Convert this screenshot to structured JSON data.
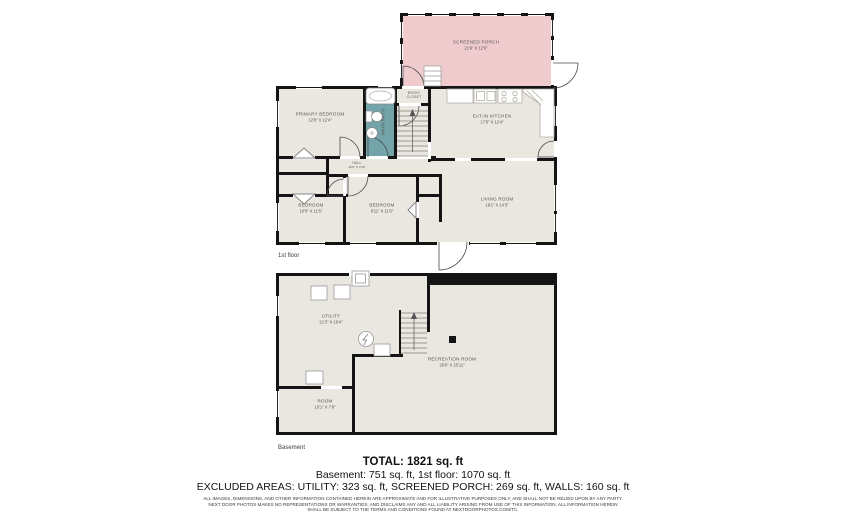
{
  "colors": {
    "floor_fill": "#e9e7e0",
    "wall": "#141414",
    "porch_fill": "#efcbce",
    "bath_fill": "#72a4aa",
    "label_text": "#56564e"
  },
  "first_floor": {
    "caption": "1st floor",
    "porch": {
      "name": "SCREENED PORCH",
      "dims": "21'9\" X 12'6\""
    },
    "primary_bedroom": {
      "name": "PRIMARY BEDROOM",
      "dims": "12'8\" X 12'4\""
    },
    "bath": {
      "name": "MAIN BATH"
    },
    "entry_closet": {
      "line1": "ENTRY",
      "line2": "CLOSET"
    },
    "kitchen": {
      "name": "EAT-IN KITCHEN",
      "dims": "17'8\" X 12'4\""
    },
    "hall": {
      "name": "HALL",
      "dims": "16'3\" X 3'10\""
    },
    "bedroom_left": {
      "name": "BEDROOM",
      "dims": "10'8\" X 11'6\""
    },
    "bedroom_mid": {
      "name": "BEDROOM",
      "dims": "8'11\" X 11'6\""
    },
    "living": {
      "name": "LIVING ROOM",
      "dims": "19'1\" X 14'3\""
    }
  },
  "basement": {
    "caption": "Basement",
    "utility": {
      "name": "UTILITY",
      "dims": "21'3\" X 19'4\""
    },
    "recreation": {
      "name": "RECREATION ROOM",
      "dims": "26'9\" X 25'11\""
    },
    "room": {
      "name": "ROOM",
      "dims": "10'1\" X 7'8\""
    }
  },
  "summary": {
    "total": "TOTAL: 1821 sq. ft",
    "floors": "Basement: 751 sq. ft, 1st floor: 1070 sq. ft",
    "excluded": "EXCLUDED AREAS: UTILITY: 323 sq. ft, SCREENED PORCH: 269 sq. ft, WALLS: 160 sq. ft",
    "disclaimer1": "ALL IMAGES, DIMENSIONS, AND OTHER INFORMATION CONTAINED HEREIN ARE APPROXIMATE AND FOR ILLUSTRATIVE PURPOSES ONLY, AND SHALL NOT BE RELIED UPON BY ANY PARTY.",
    "disclaimer2": "NEXT DOOR PHOTOS MAKES NO REPRESENTATIONS OR WARRANTIES, AND DISCLAIMS ANY AND ALL LIABILITY ARISING FROM USE OF THIS INFORMATION. ALL INFORMATION HEREIN",
    "disclaimer3": "SHALL BE SUBJECT TO THE TERMS AND CONDITIONS FOUND AT NEXTDOORPHOTOS.COM/TC."
  }
}
